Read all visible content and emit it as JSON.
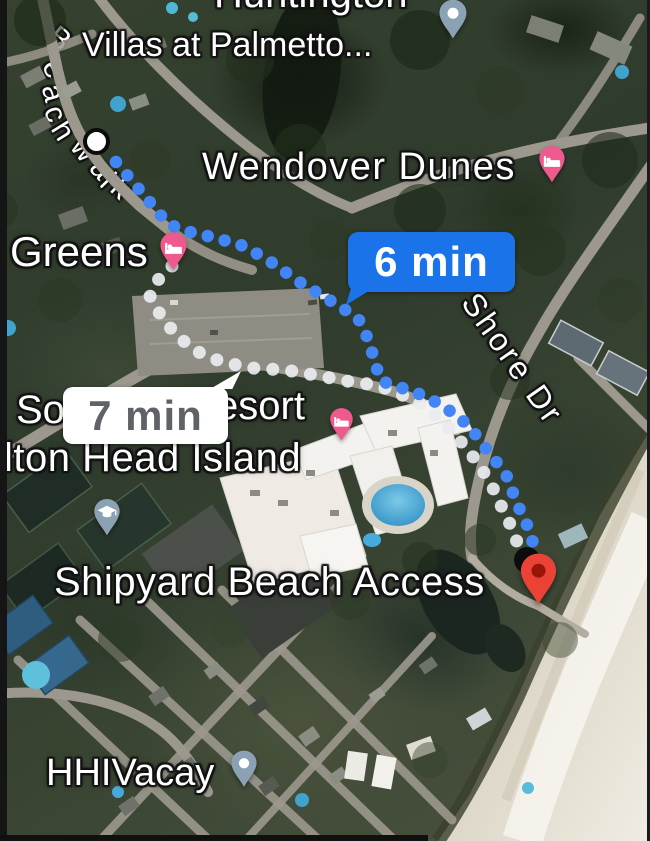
{
  "app": {
    "view_name": "satellite-map-walking-route"
  },
  "map_labels": {
    "huntington": "Huntington",
    "villas": "Villas at Palmetto...",
    "wendover": "Wendover Dunes",
    "greens": "Greens",
    "sonesta_left": "So",
    "sonesta_right": "esort",
    "sonesta_line2": "lton Head Island",
    "shipyard": "Shipyard Beach Access",
    "hhivacay": "HHIVacay"
  },
  "street_labels": {
    "beachwalk": "Beachwalk",
    "shore_dr": "Shore Dr"
  },
  "route": {
    "primary_eta": "6 min",
    "alternate_eta": "7 min",
    "primary_dot_color": "#4285f4",
    "alternate_dot_color": "#e9ecef",
    "primary_bubble_bg": "#1a73e8",
    "primary_bubble_fg": "#ffffff",
    "alternate_bubble_bg": "#ffffff",
    "alternate_bubble_fg": "#5f6368"
  },
  "pins": {
    "lodging_color": "#ee5a8e",
    "poi_color": "#8ba2b4",
    "destination_color": "#ea4335",
    "destination_label": "Shipyard Beach Access"
  }
}
